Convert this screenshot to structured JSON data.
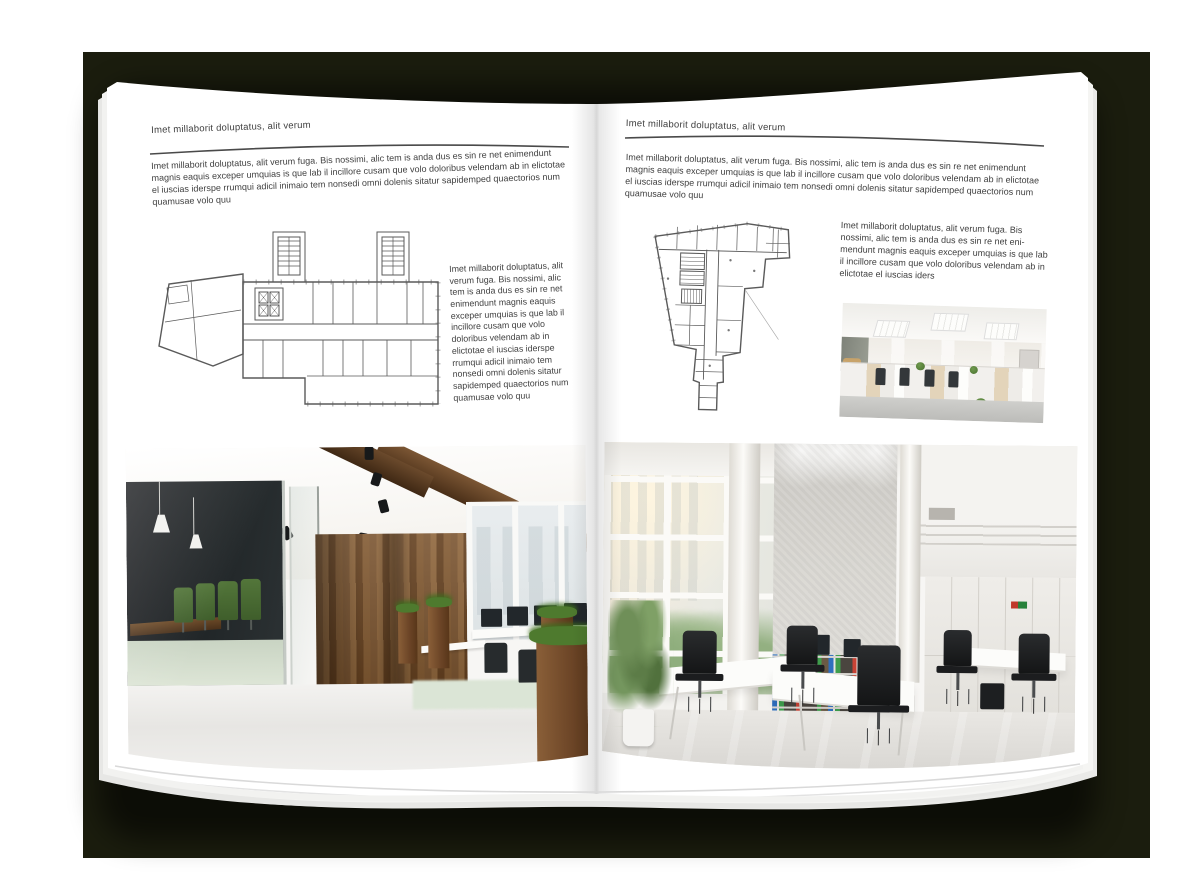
{
  "colors": {
    "backdrop": "#1b1d0e",
    "page": "#ffffff",
    "text": "#3f3f3f",
    "rule": "#4a4a4a",
    "plan-stroke": "#5a5a5a",
    "wood": "#7b5531",
    "wood-dark": "#64401f",
    "grass": "#4e7a2e",
    "chair-green": "#3f5e2b",
    "binder-blue": "#2f6fbe",
    "binder-green": "#3f9e4d",
    "binder-red": "#c94335",
    "concrete": "#cdcbc6"
  },
  "left_page": {
    "header": "Imet millaborit doluptatus, alit verum",
    "intro": "Imet millaborit doluptatus, alit verum fuga. Bis nossimi, alic tem is anda dus es sin re net enimendunt magnis eaquis exceper umquias is que lab il incillore cusam que volo doloribus velendam ab in elictotae el iuscias iderspe rrumqui adicil inimaio tem nonsedi omni dolenis sitatur sapidemped quaectorios num quamusae volo quu",
    "side_text": "Imet millaborit doluptatus, alit verum fuga. Bis nossimi, alic tem is anda dus es sin re net enimendunt magnis eaquis exceper umquias is que lab il incillore cusam que volo doloribus velendam ab in elictotae el iuscias iderspe rrumqui adicil inimaio tem nonsedi omni dolenis sitatur sapidemped quaectorios num quamusae volo quu"
  },
  "right_page": {
    "header": "Imet millaborit doluptatus, alit verum",
    "intro": "Imet millaborit doluptatus, alit verum fuga. Bis nossimi, alic tem is anda dus es sin re net enimendunt magnis eaquis exceper umquias is que lab il incillore cusam que volo doloribus velendam ab in elictotae el iuscias iderspe rrumqui adicil inimaio tem nonsedi omni dolenis sitatur sapidemped quaectorios num quamusae volo quu",
    "side_text": "Imet millaborit doluptatus, alit verum fuga. Bis nossimi, alic tem is anda dus es sin re net eni-mendunt magnis eaquis exceper umquias is que lab il incillore cusam que volo doloribus velendam ab in elictotae el iuscias iders"
  }
}
